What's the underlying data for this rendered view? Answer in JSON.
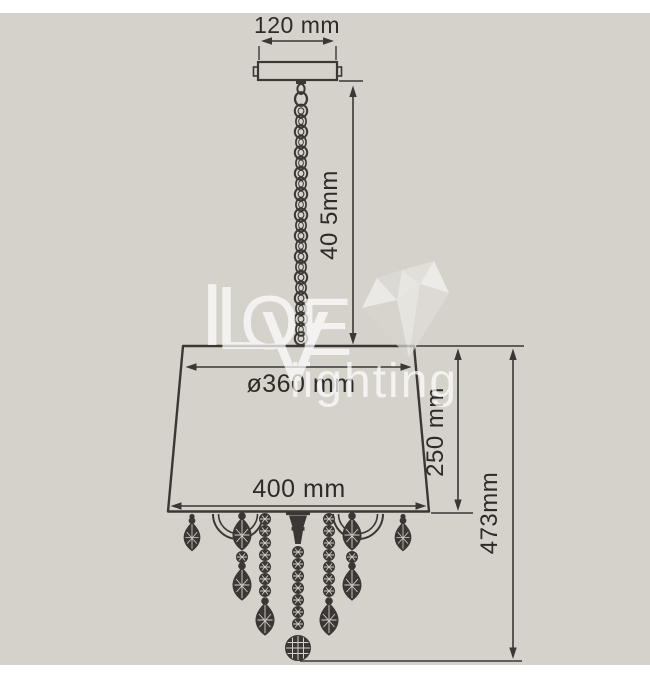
{
  "page": {
    "background_main": "#d5d2cb",
    "background_strip": "#ffffff",
    "line_color": "#3a3734",
    "text_color": "#2d2a27",
    "watermark_color": "#ffffff"
  },
  "diagram": {
    "type": "technical-drawing",
    "subject": "pendant chandelier with conical shade, suspension chain and crystal drops",
    "dimensions": {
      "canopy_width": "120 mm",
      "chain_drop": "40 5mm",
      "shade_top_diameter": "ø360 mm",
      "shade_height": "250 mm",
      "shade_bottom_width": "400 mm",
      "total_body_height": "473mm"
    }
  },
  "watermark": {
    "letters": [
      "I",
      "L",
      "O",
      "V",
      "E"
    ],
    "word": "lighting",
    "heart_icon": "faceted-heart"
  }
}
